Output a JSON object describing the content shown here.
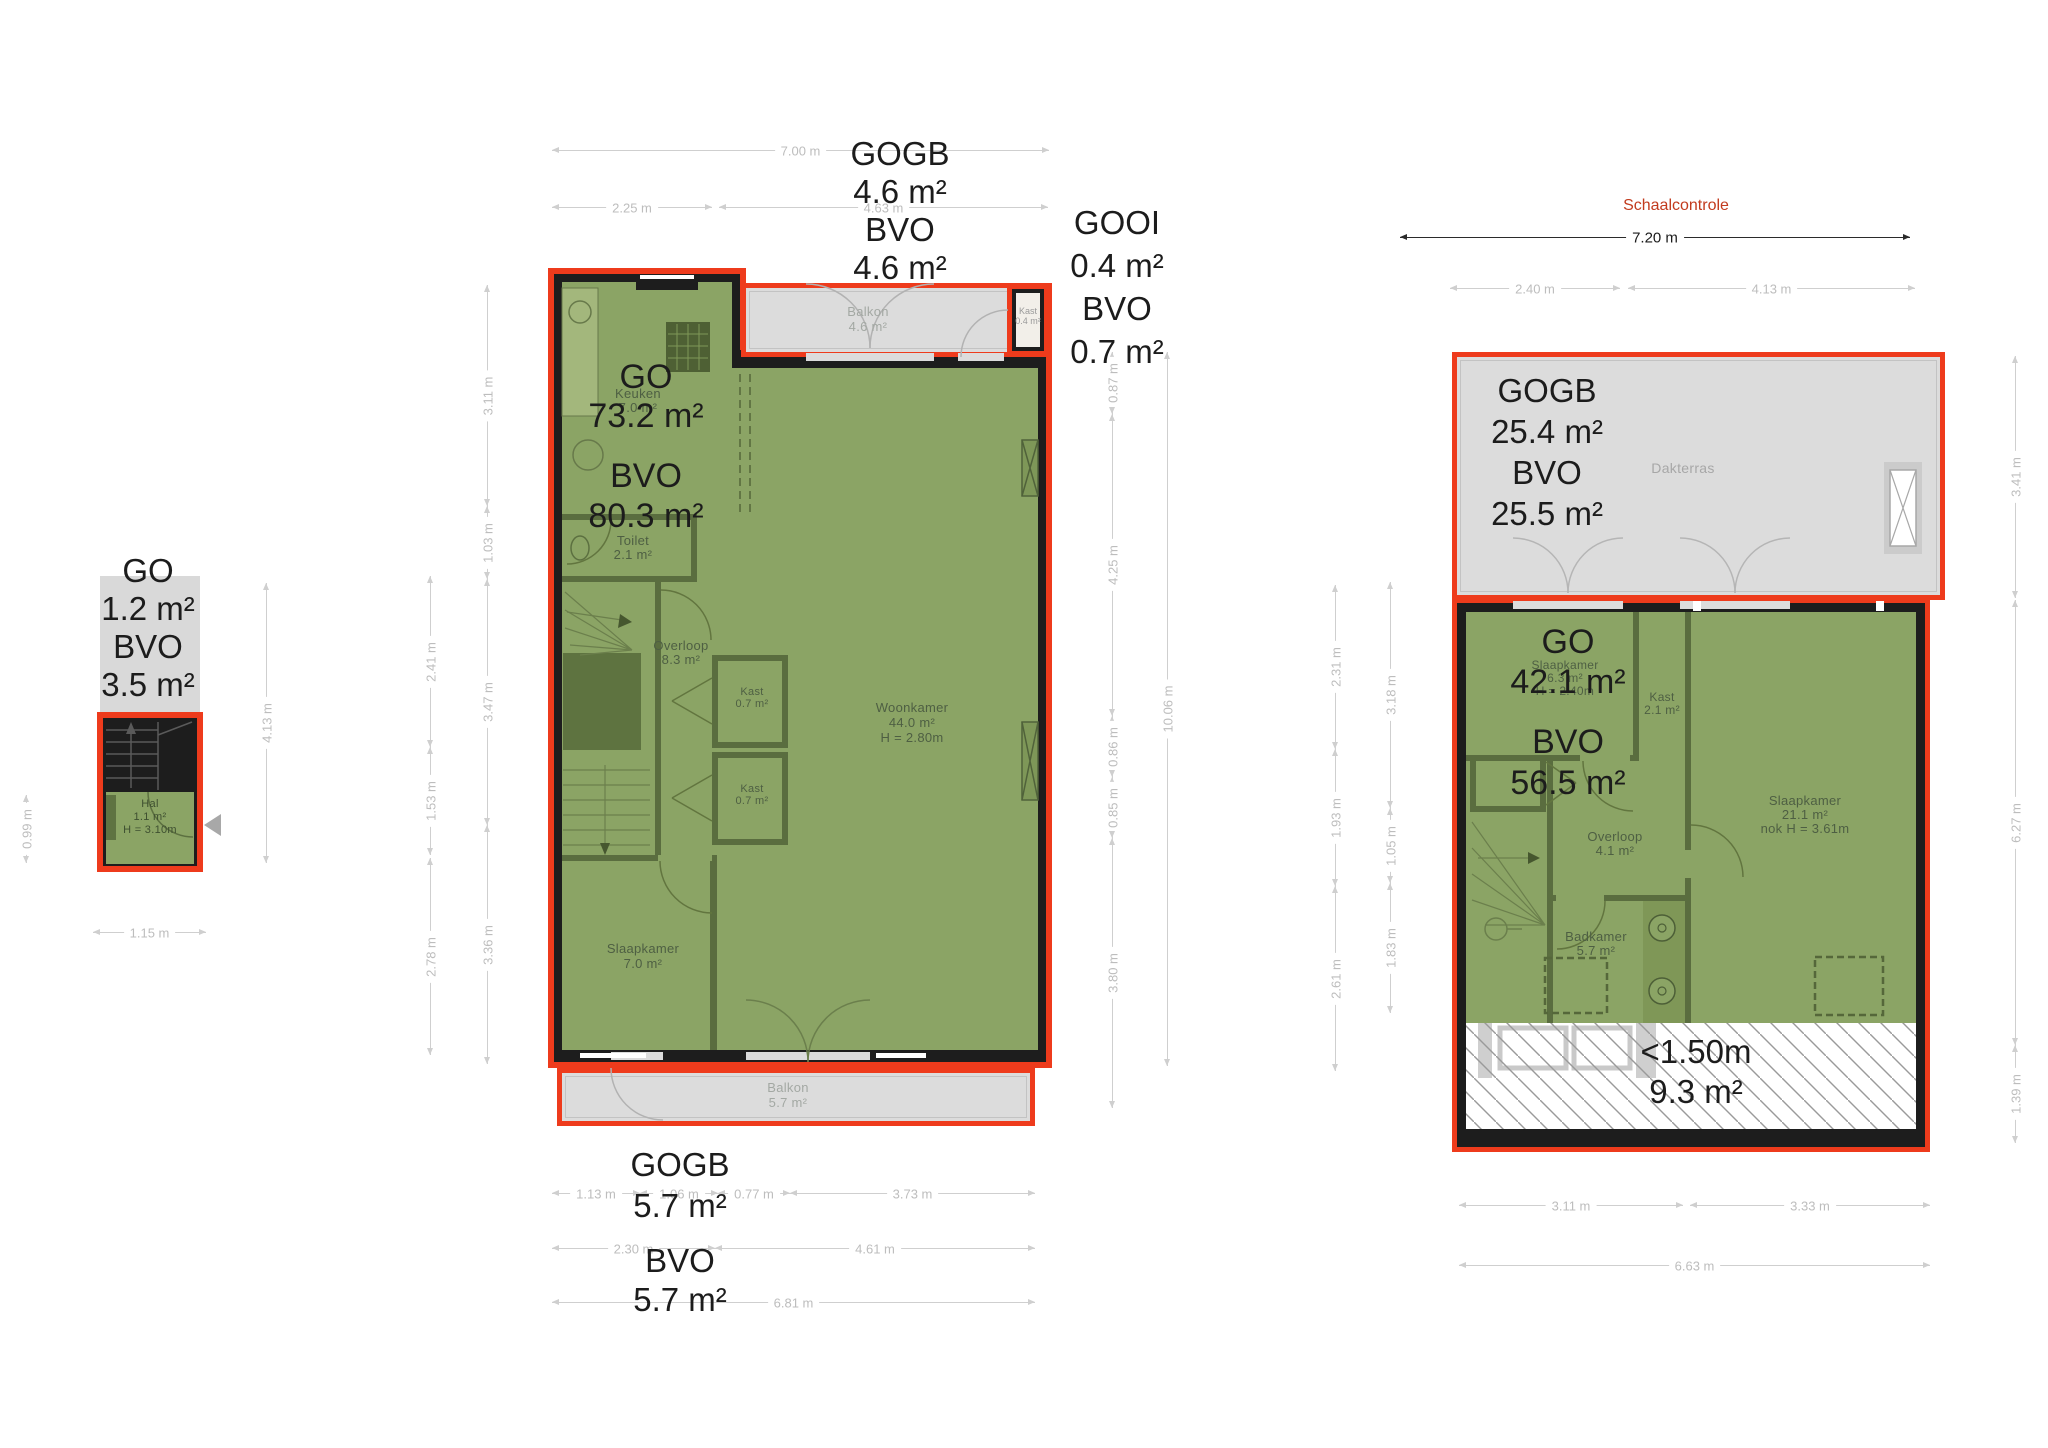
{
  "scale_check": {
    "title": "Schaalcontrole",
    "dim": "7.20 m"
  },
  "hal": {
    "area_labels": [
      "GO",
      "1.2 m²",
      "BVO",
      "3.5 m²"
    ],
    "room": {
      "name": "Hal",
      "area": "1.1 m²",
      "height": "H = 3.10m"
    },
    "dims": {
      "left": "0.99 m",
      "right": "4.13 m",
      "bottom": "1.15 m"
    }
  },
  "first_floor": {
    "top_labels": [
      "GOGB",
      "4.6 m²",
      "BVO",
      "4.6 m²"
    ],
    "kast_labels": [
      "GOOI",
      "0.4 m²",
      "BVO",
      "0.7 m²"
    ],
    "main_labels": [
      "GO",
      "73.2 m²",
      "BVO",
      "80.3 m²"
    ],
    "bottom_labels": [
      "GOGB",
      "5.7 m²",
      "BVO",
      "5.7 m²"
    ],
    "rooms": {
      "balkon_top": {
        "name": "Balkon",
        "area": "4.6 m²"
      },
      "kast_balkon": {
        "name": "Kast",
        "area": "0.4 m²"
      },
      "keuken": {
        "name": "Keuken",
        "area": "7.0 m²"
      },
      "toilet": {
        "name": "Toilet",
        "area": "2.1 m²"
      },
      "overloop": {
        "name": "Overloop",
        "area": "8.3 m²"
      },
      "kast1": {
        "name": "Kast",
        "area": "0.7 m²"
      },
      "kast2": {
        "name": "Kast",
        "area": "0.7 m²"
      },
      "woonkamer": {
        "name": "Woonkamer",
        "area": "44.0 m²",
        "height": "H = 2.80m"
      },
      "slaapkamer": {
        "name": "Slaapkamer",
        "area": "7.0 m²"
      },
      "balkon_bottom": {
        "name": "Balkon",
        "area": "5.7 m²"
      }
    },
    "dims": {
      "top": [
        "7.00 m",
        "2.25 m",
        "4.63 m"
      ],
      "left_outer": [
        "2.41 m",
        "1.53 m",
        "2.78 m"
      ],
      "left_inner": [
        "3.11 m",
        "1.03 m",
        "3.47 m",
        "3.36 m"
      ],
      "right_inner": [
        "0.87 m",
        "4.25 m",
        "0.86 m",
        "0.85 m",
        "3.80 m"
      ],
      "right_outer": [
        "10.06 m"
      ],
      "bottom_row1": [
        "1.13 m",
        "1.06 m",
        "0.77 m",
        "3.73 m"
      ],
      "bottom_row2": [
        "2.30 m",
        "4.61 m"
      ],
      "bottom_row3": [
        "6.81 m"
      ]
    }
  },
  "second_floor": {
    "terrace_labels": [
      "GOGB",
      "25.4 m²",
      "BVO",
      "25.5 m²"
    ],
    "main_labels": [
      "GO",
      "42.1 m²",
      "BVO",
      "56.5 m²"
    ],
    "low_height_labels": [
      "<1.50m",
      "9.3 m²"
    ],
    "rooms": {
      "dakterras": {
        "name": "Dakterras"
      },
      "slaapkamer1": {
        "name": "Slaapkamer",
        "area": "6.3 m²",
        "height": "H = 2.40m"
      },
      "kast": {
        "name": "Kast",
        "area": "2.1 m²"
      },
      "slaapkamer2": {
        "name": "Slaapkamer",
        "area": "21.1 m²",
        "height": "nok H = 3.61m"
      },
      "overloop": {
        "name": "Overloop",
        "area": "4.1 m²"
      },
      "badkamer": {
        "name": "Badkamer",
        "area": "5.7 m²"
      }
    },
    "dims": {
      "top": [
        "2.40 m",
        "4.13 m"
      ],
      "left_outer": [
        "2.31 m",
        "1.93 m",
        "2.61 m"
      ],
      "left_inner": [
        "3.18 m",
        "1.05 m",
        "1.83 m"
      ],
      "right": [
        "3.41 m",
        "6.27 m",
        "1.39 m"
      ],
      "bottom_row1": [
        "3.11 m",
        "3.33 m"
      ],
      "bottom_row2": [
        "6.63 m"
      ]
    }
  },
  "colors": {
    "outline": "#ee3b1c",
    "floor": "#8ba465",
    "terrace": "#dcdcdc",
    "wall": "#1d1d1d",
    "scale_text": "#c23b1e"
  }
}
